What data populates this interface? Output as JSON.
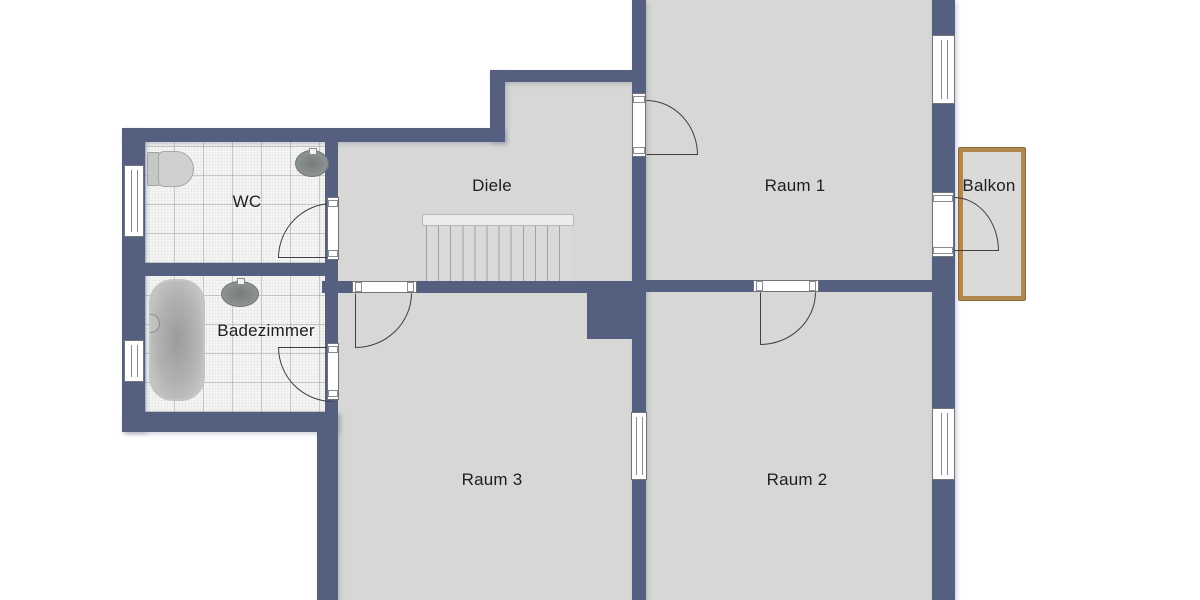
{
  "floorplan": {
    "type": "floor-plan",
    "rooms": [
      {
        "id": "wc",
        "label": "WC"
      },
      {
        "id": "badezimmer",
        "label": "Badezimmer"
      },
      {
        "id": "diele",
        "label": "Diele"
      },
      {
        "id": "raum1",
        "label": "Raum 1"
      },
      {
        "id": "raum2",
        "label": "Raum 2"
      },
      {
        "id": "raum3",
        "label": "Raum 3"
      },
      {
        "id": "balkon",
        "label": "Balkon"
      }
    ],
    "fixtures": [
      "toilet",
      "sink",
      "bathtub",
      "staircase"
    ],
    "features": {
      "windows_exterior": 4,
      "windows_interior": 1,
      "doors": 6,
      "staircase_location": "diele"
    },
    "colors": {
      "wall": "#556080",
      "room_floor": "#d7d7d5",
      "tile_floor": "#f5f5f3",
      "balcony_wood": "#b3884f",
      "balcony_floor": "#dadad8",
      "outside": "#ffffff",
      "label_text": "#1e1e1e"
    }
  }
}
